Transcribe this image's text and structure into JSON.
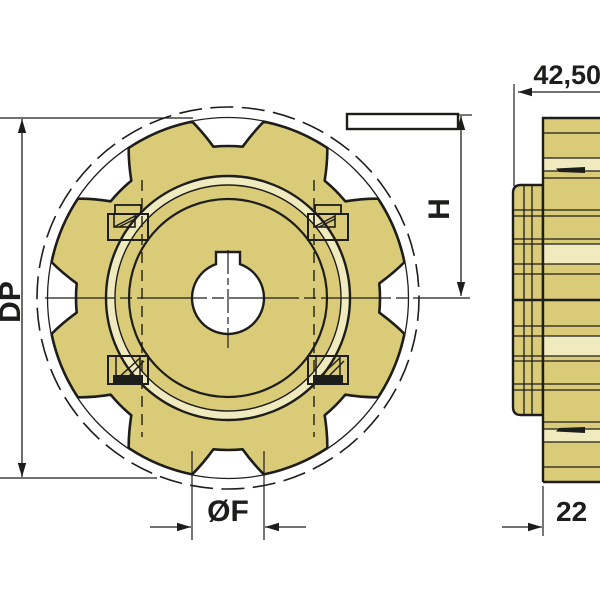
{
  "drawing": {
    "teeth_count": 8,
    "dimension_labels": {
      "pitch_diameter": "DP",
      "height": "H",
      "bore_diameter": "ØF",
      "overall_width": "42,50",
      "disc_width": "22"
    },
    "colors": {
      "body": "#dacb78",
      "ring_highlight": "#f0eabf",
      "line": "#1d1d1b",
      "background": "#ffffff"
    }
  }
}
